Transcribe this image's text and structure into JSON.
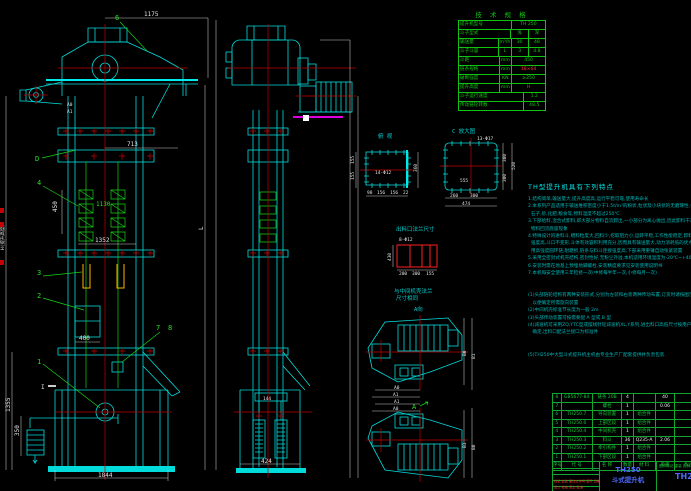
{
  "colors": {
    "background": "#000000",
    "line_cyan": "#00dcdc",
    "line_green": "#16d416",
    "centerline_red": "#c00000",
    "dim_white": "#e2e2e2",
    "bucket_yellow": "#ffb400",
    "magenta": "#ff00ff",
    "title_blue": "#4d6bff",
    "table_green": "#12c412",
    "notes_teal": "#00b4b4",
    "highlight_red": "#ff3030"
  },
  "spec_table": {
    "title": "技 术 规 格",
    "rows": [
      {
        "label": "提升机型号",
        "value": "TH 250"
      },
      {
        "label": "斗子型式",
        "v1": "浅",
        "v2": "深"
      },
      {
        "label": "输送量",
        "unit": "m³/h",
        "v1": "30",
        "v2": "48"
      },
      {
        "label": "斗子斗容",
        "unit": "L",
        "v1": "3",
        "v2": "4.8"
      },
      {
        "label": "斗距",
        "unit": "mm",
        "value": "450"
      },
      {
        "label": "链条规格",
        "unit": "mm",
        "value": "18×64"
      },
      {
        "label": "破断强度",
        "unit": "KN",
        "value": "≥250"
      },
      {
        "label": "提升高度",
        "unit": "mm",
        "value": "H"
      },
      {
        "label": "斗子运行速度",
        "unit": "m/s",
        "value": "1.2"
      },
      {
        "label": "传动链轮转数",
        "unit": "r/min",
        "value": "48.5"
      }
    ]
  },
  "notes": {
    "heading": "TH型提升机具有下列特点",
    "body": "1.结构简单,输送量大,提升高度高,运行平稳可靠,使用寿命长\n2.本系列产品适用于输送堆积密度小于1.5t/m³的粉状,粒状及小块状的无磨琢性,半磨琢性物料,如煤,水泥,\n  石子,砂,化肥,粮食等,物料温度不超过250℃\n3.下部给料,混合式卸料,即大部分物料自流卸出,一小部分为离心抛出,因此卸料干净,几乎没有\n  物料回流底座现象\n4.特殊设计的进料斗,喂料粒度大,回料少,挖取阻力小,运转平稳,工作性能稳定,卸料充分彻底,料斗\n  强度高,斗口不变形,斗体有效容积利用充分,因而具有输送量大,动力消耗低的优点,输送链采\n  用高强度圆环链,耐磨损,链条与料斗连接强度高,下部采用重锤自动张紧装置\n5.采用全密封式机壳结构,密封性好,无粉尘外溢,本机适用环境温度为-20℃~+40℃,室内外均可使用\n6.安装时需在地基上预埋地脚螺栓,安装精度要求见安装使用说明书\n7.本机每安全使用三年检修一次(中修每半年一次,小修每月一次)\n\n\n(1)头部链轮结构有两种安装形式,分别为左装和右装两种传动布置,订货时请按图示方向注明,\n   以便确定所需旋向装置\n(2)中间机壳标准节长度为一般 2m\n(3)头部传动装置可按需要配 A 型或 B 型\n(4)减速机可采用ZQ,YTC型或摆线针轮减速机XL,Y系列,进出料口高低尺寸按用户条件\n   确定,出料口配法兰接口为标准件\n\n\n(5)TH250中大型斗式提升机主机由专业生产厂配套提供并负责包装."
  },
  "bom": {
    "header": [
      "序号",
      "代 号",
      "名 称",
      "数量",
      "材 料",
      "单重",
      "备注"
    ],
    "rows": [
      [
        "8",
        "GB5677-84",
        "链条 20B",
        "4",
        "",
        "40",
        ""
      ],
      [
        "7",
        "",
        "螺栓",
        "1",
        "",
        "0.06",
        ""
      ],
      [
        "6",
        "TH250.7",
        "导向装置",
        "1",
        "组合件",
        "",
        ""
      ],
      [
        "5",
        "TH250.6",
        "上部区段",
        "1",
        "组合件",
        "",
        ""
      ],
      [
        "4",
        "TH250.4",
        "中间机壳",
        "1",
        "组合件",
        "",
        ""
      ],
      [
        "3",
        "TH250.3",
        "料斗",
        "36",
        "Q235-A",
        "2.06",
        ""
      ],
      [
        "2",
        "TH250.2",
        "牵引构件",
        "1",
        "组合件",
        "",
        ""
      ],
      [
        "1",
        "TH250.1",
        "下部区段",
        "1",
        "组合件",
        "",
        ""
      ]
    ]
  },
  "title_block": {
    "model": "TH250",
    "product": "斗式提升机",
    "drawing_no": "TH250",
    "rev_row": "标记 处数 更改文件号 签字 日期",
    "sign_row": "设计  校核  审定  批准",
    "info_row": "图样标记 重量 比例"
  },
  "views": {
    "plan_left_title": "俯 视",
    "plan_right_title": "C 放大图",
    "flange_title": "出料口法兰尺寸",
    "flange_note1": "与中间机壳法兰",
    "flange_note2": "尺寸相同",
    "aux_label": "A向"
  },
  "leaders": {
    "l1": "1",
    "l2": "2",
    "l3": "3",
    "l4": "4",
    "l6": "6",
    "l7": "7",
    "l8": "8",
    "d": "D",
    "sec": "I",
    "a0": "A0",
    "a1": "A1",
    "a": "A"
  },
  "dims": {
    "top": "1175",
    "d713": "713",
    "g1130": "1130",
    "v450": "450",
    "d1352": "1352",
    "door400": "400",
    "left1355": "1355",
    "left350": "350",
    "bottom1844": "1844",
    "height_label": "H(提升高度)",
    "len_label": "L",
    "mid144": "144",
    "mid424": "424",
    "p1_l1": "155",
    "p1_l2": "155",
    "p1_r": "360",
    "p1_b1": "98",
    "p1_b2": "156",
    "p1_b3": "156",
    "p1_b4": "22",
    "p1_holes": "14-Φ12",
    "p2_c": "555",
    "p2_holes": "13-Φ17",
    "p2_b1": "260",
    "p2_b2": "300",
    "p2_b": "474",
    "p2_r1": "300",
    "p2_r2": "300",
    "p2_r": "520",
    "f_b1": "200",
    "f_b2": "300",
    "f_b3": "155",
    "f_l": "430",
    "f_holes": "8-Φ12",
    "hd_a0": "A0",
    "hd_a1": "A1",
    "hd_b0": "B0",
    "hd_b1": "B1",
    "hd2_a1": "A1",
    "hd2_a0": "A0",
    "hd2_b1": "B1",
    "hd2_b0": "B0"
  }
}
